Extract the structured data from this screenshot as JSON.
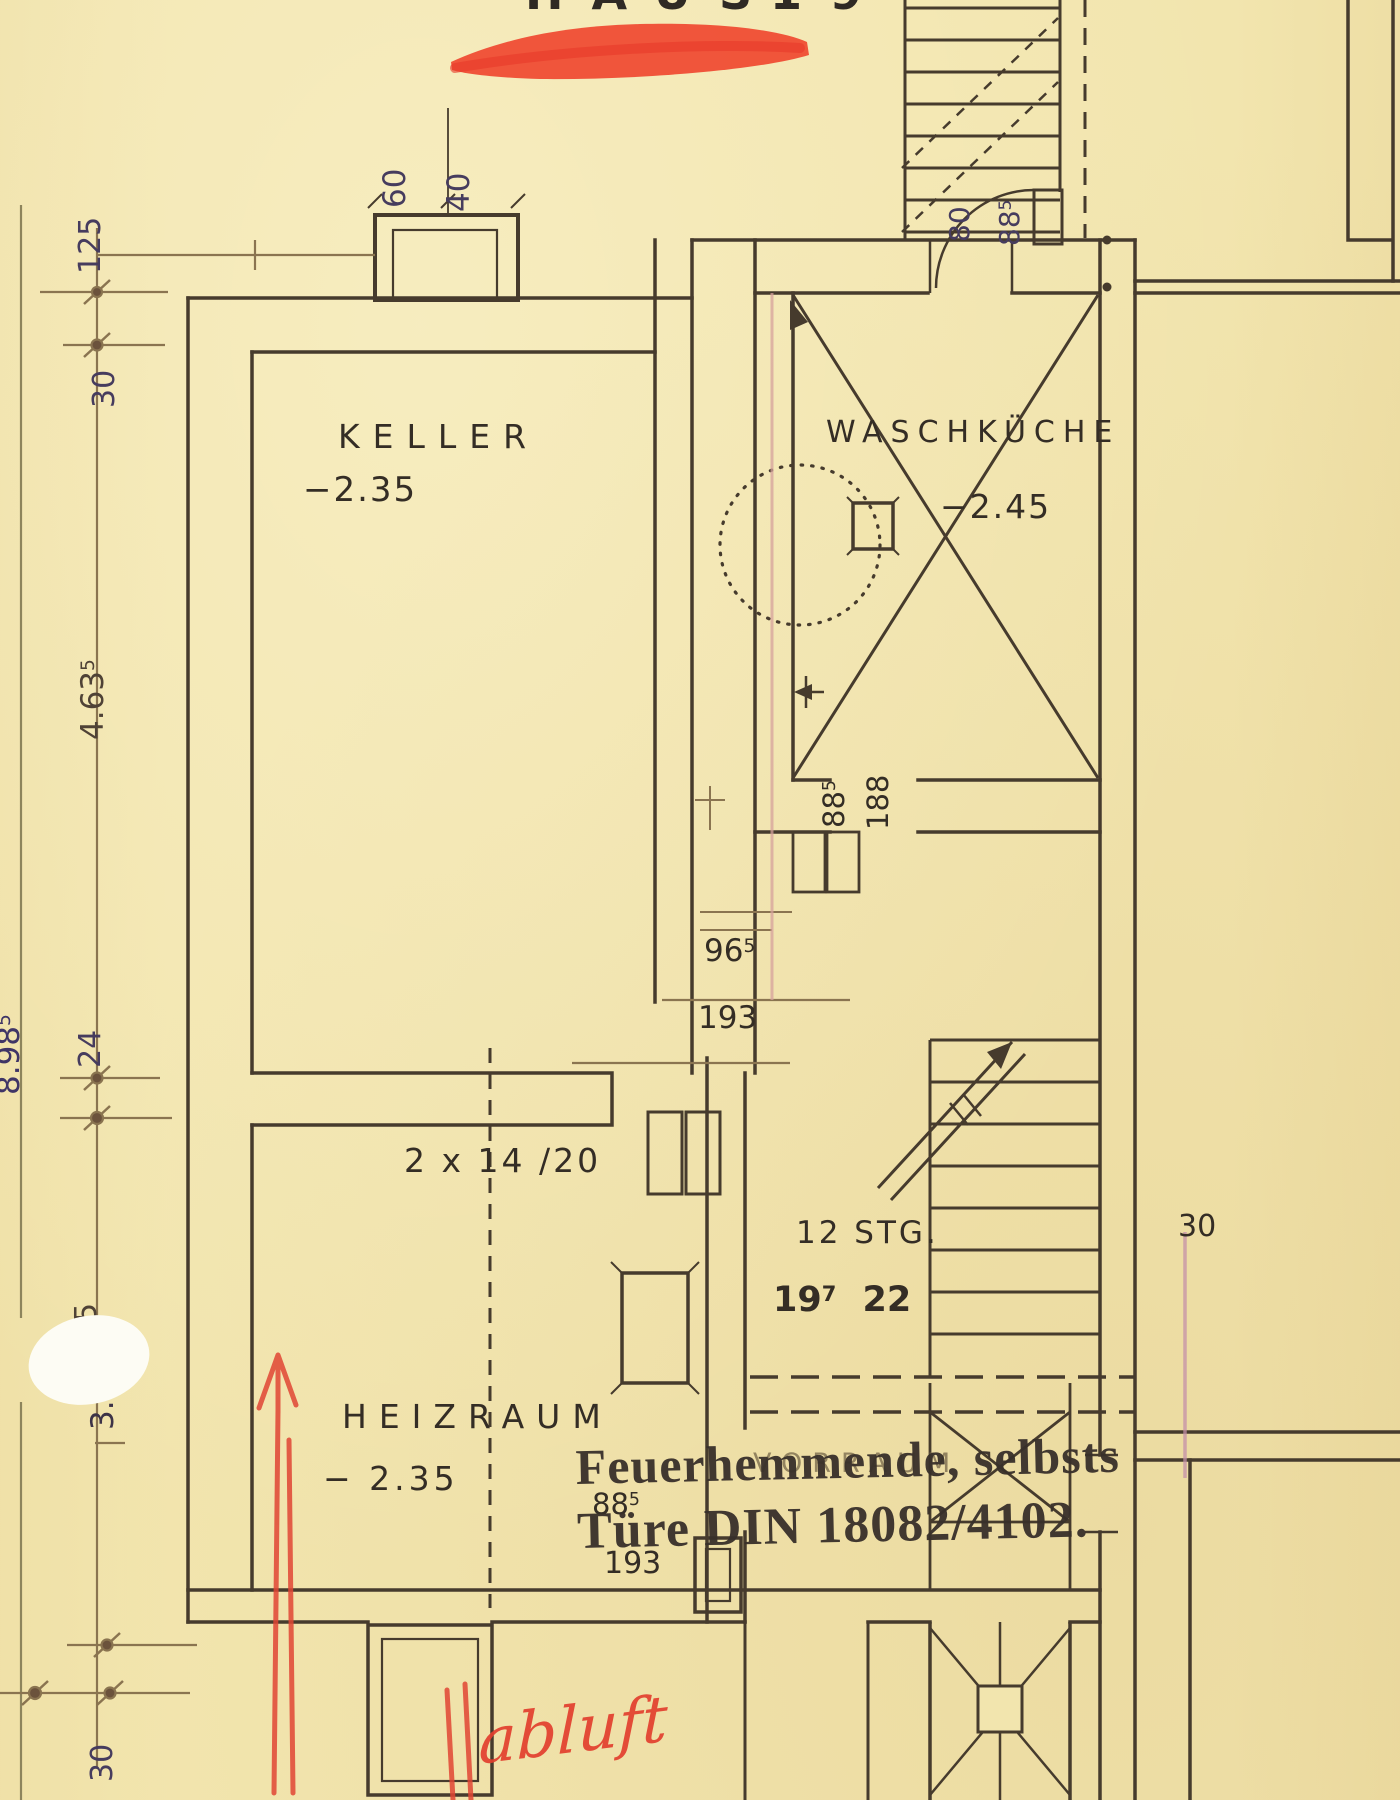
{
  "header": {
    "title": "HAUS",
    "number": "19"
  },
  "rooms": {
    "keller": {
      "name": "KELLER",
      "level": "−2.35"
    },
    "waschkueche": {
      "name": "WASCHKÜCHE",
      "level": "−2.45"
    },
    "heizraum": {
      "name": "HEIZRAUM",
      "level": "− 2.35"
    },
    "vorraum": {
      "name": "VORRAUM"
    }
  },
  "stairs": {
    "count": "12 STG.",
    "rise": "19",
    "rise_sup": "7",
    "run": "22"
  },
  "chimney": {
    "w": "60",
    "d": "40",
    "flues": "2 x 14 /20"
  },
  "doors": {
    "keller_door": {
      "w": "96",
      "w_sup": "5",
      "h": "193"
    },
    "waschkueche_door": {
      "w": "88",
      "w_sup": "5",
      "h": "188"
    },
    "vorraum_door": {
      "w": "88",
      "w_sup": "5",
      "h": "193"
    },
    "upper_door": {
      "leaf": "80",
      "opening": "88",
      "opening_sup": "5"
    }
  },
  "dimensions": {
    "left_chain": {
      "d125": "125",
      "d30_top": "30",
      "d4635": "4.63",
      "d4635_sup": "5",
      "d24": "24",
      "d3_5_a": "5",
      "d3_5_b": "3.",
      "d30_bottom": "30",
      "total": "8.98",
      "total_sup": "5"
    },
    "right": "30"
  },
  "stamp": {
    "line1": "Feuerhemmende, selbsts",
    "line2": "Türe DIN 18082/4102."
  },
  "handwriting": {
    "abluft": "abluft"
  },
  "colors": {
    "paper": "#f2e5ae",
    "ink": "#463b2d",
    "dim": "#8a7450",
    "red": "#e8392a",
    "stamp_ink": "#38302a"
  }
}
